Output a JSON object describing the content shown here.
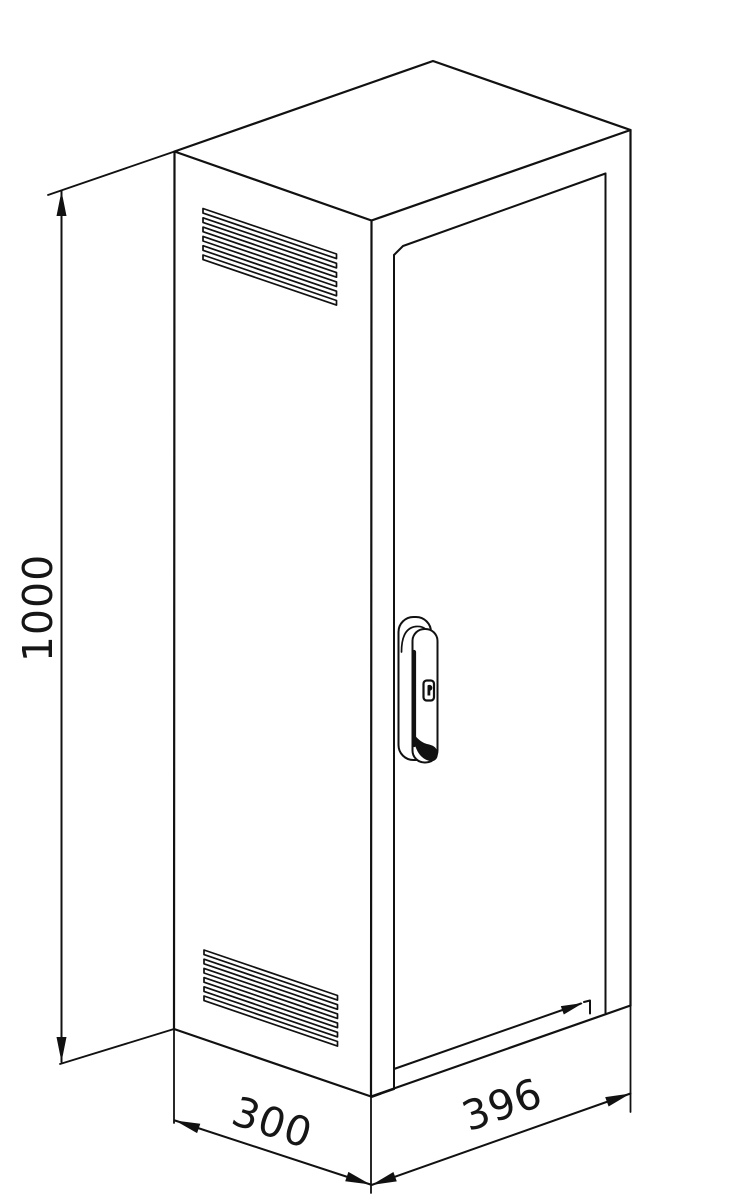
{
  "drawing": {
    "title": "Isometric technical drawing of a ventilated enclosure cabinet",
    "dimensions": {
      "height_label": "1000",
      "width_label": "300",
      "depth_label": "396"
    },
    "features": {
      "vent_top": "louver-vent-6-slats",
      "vent_bottom": "louver-vent-6-slats",
      "door": "right-face-door-panel",
      "handle": "swing-handle-with-keyhole"
    }
  },
  "colors": {
    "line": "#111111",
    "background": "#ffffff"
  }
}
